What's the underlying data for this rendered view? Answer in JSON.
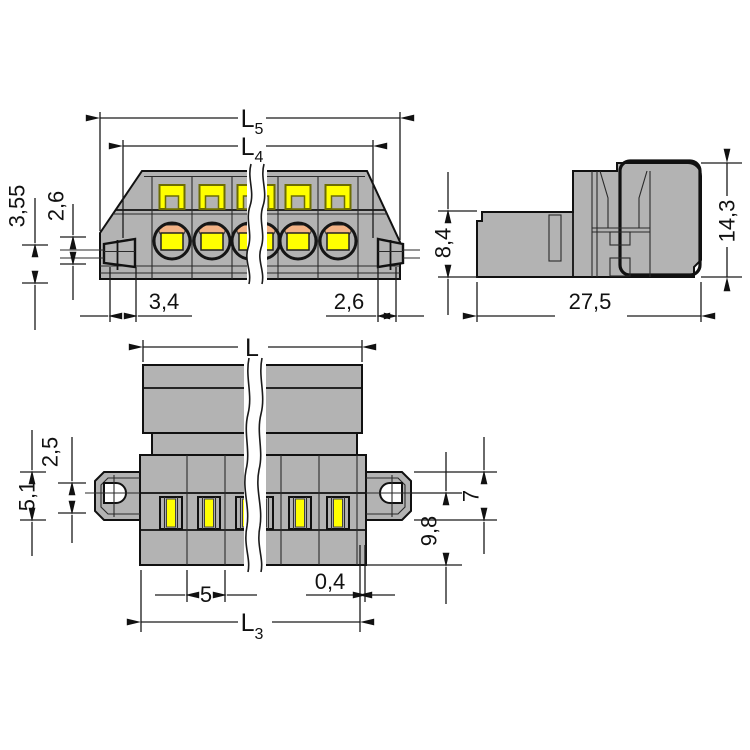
{
  "colors": {
    "bg": "#ffffff",
    "gray": "#b3b3b3",
    "yellow": "#ffff00",
    "orange": "#f3b285",
    "line": "#111111",
    "olive": "#6e6e00"
  },
  "dims": {
    "front": {
      "l5_main": "L",
      "l5_sub": "5",
      "l4_main": "L",
      "l4_sub": "4",
      "h355": "3,55",
      "h26": "2,6",
      "w34": "3,4",
      "w26": "2,6"
    },
    "side": {
      "h84": "8,4",
      "h143": "14,3",
      "d275": "27,5"
    },
    "plan": {
      "l_main": "L",
      "l3_main": "L",
      "l3_sub": "3",
      "f25": "2,5",
      "f51": "5,1",
      "f7": "7",
      "f98": "9,8",
      "pitch5": "5",
      "gap04": "0,4"
    }
  }
}
